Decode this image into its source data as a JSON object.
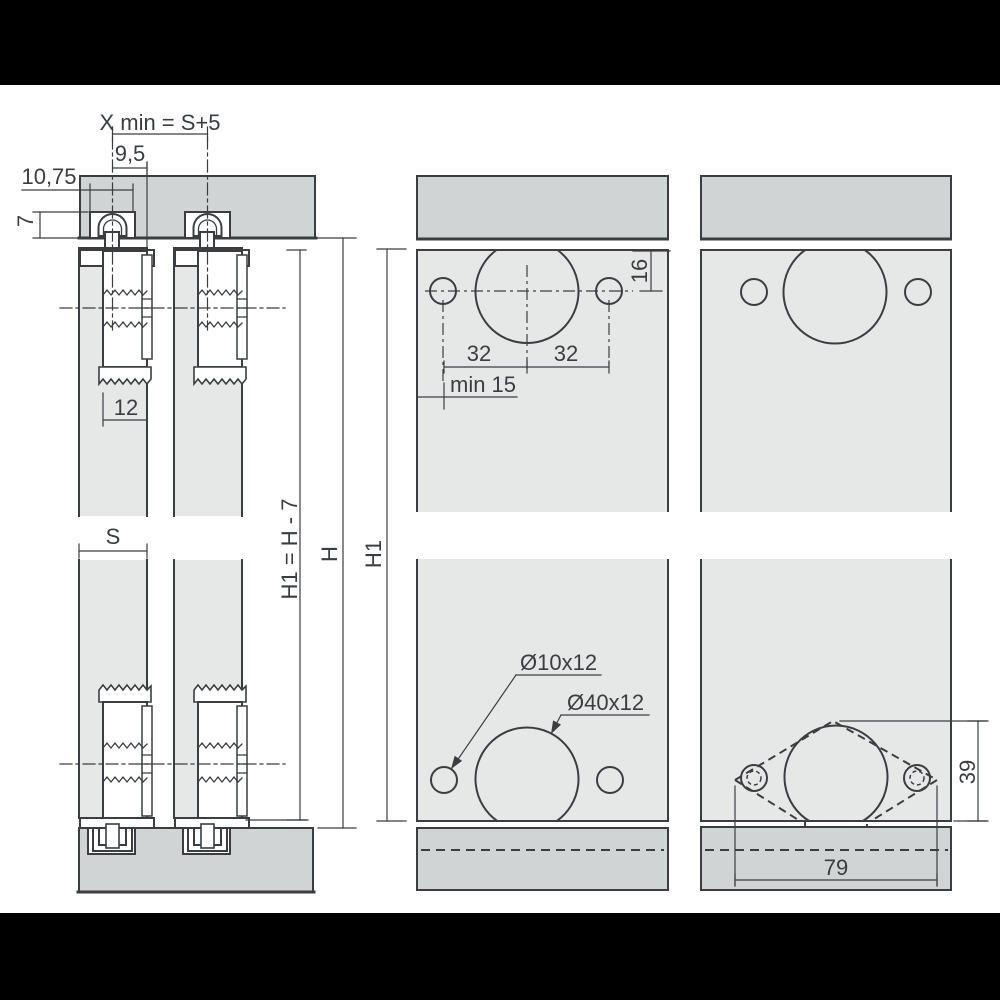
{
  "drawing": {
    "type": "sliding-door-fitting installation drawing",
    "labels": {
      "xmin": "X min = S+5",
      "w95": "9,5",
      "w1075": "10,75",
      "h7": "7",
      "w12": "12",
      "s": "S",
      "h1_formula": "H1 = H - 7",
      "h": "H",
      "h1": "H1",
      "d16": "16",
      "d32_left": "32",
      "d32_right": "32",
      "min15": "min 15",
      "small_hole": "Ø10x12",
      "large_hole": "Ø40x12",
      "d39": "39",
      "d79": "79"
    },
    "colors": {
      "background": "#000000",
      "sheet": "#ffffff",
      "rail": "#d1d4d5",
      "panel": "#e6e8e8",
      "hardware": "#ffffff",
      "line": "#3a3e41"
    }
  }
}
